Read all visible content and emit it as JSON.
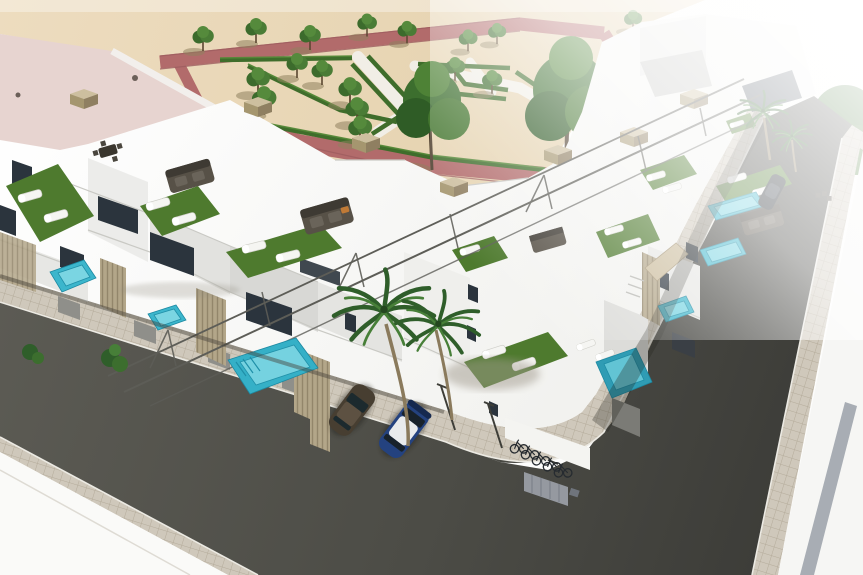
{
  "scene": {
    "title": "Aerial 3D render: new-build white townhouse complex with rooftop terraces, private pools, formal hedge garden and corner street",
    "type": "architectural-render"
  },
  "palette": {
    "sand": "#ead9bc",
    "path_red": "#b26b6b",
    "path_red_dark": "#9d5d5f",
    "hedge_green": "#3f6d2b",
    "tree_green": "#4a7c36",
    "turf_green": "#4e7a2e",
    "building_white": "#fbfbfa",
    "facade_shadow": "#d3d3d0",
    "glass_dark": "#2b343d",
    "wood_tan": "#b3a689",
    "pool_teal": "#3cb6cc",
    "pool_light": "#85dbe7",
    "asphalt": "#54544d",
    "asphalt_dark": "#3b3b37",
    "paver": "#cfc8bb",
    "roof_pink": "#e7d4d0",
    "car_blue": "#24427f",
    "car_bronze": "#473e31",
    "car_black": "#20262c",
    "palm_green": "#2f5e2a",
    "stripe_gray": "#9aa0a8"
  },
  "objects": {
    "park": {
      "label": "formal garden with red walkways, white gravel paths and hedge parterres",
      "small_trees": 18,
      "large_trees": 3
    },
    "residential_block": {
      "label": "two rows of white townhouses with rooftop terraces",
      "units_visible": 10,
      "features": [
        "artificial turf terraces",
        "sun loungers",
        "outdoor sofa sets",
        "steel pergola frames",
        "private plunge pools",
        "slatted wood fences"
      ]
    },
    "pools": 7,
    "streets": {
      "label": "asphalt corner street with paver sidewalks and parking bays"
    },
    "vehicles": {
      "cars": 3,
      "bicycles": 5
    },
    "palm_trees": 4
  }
}
